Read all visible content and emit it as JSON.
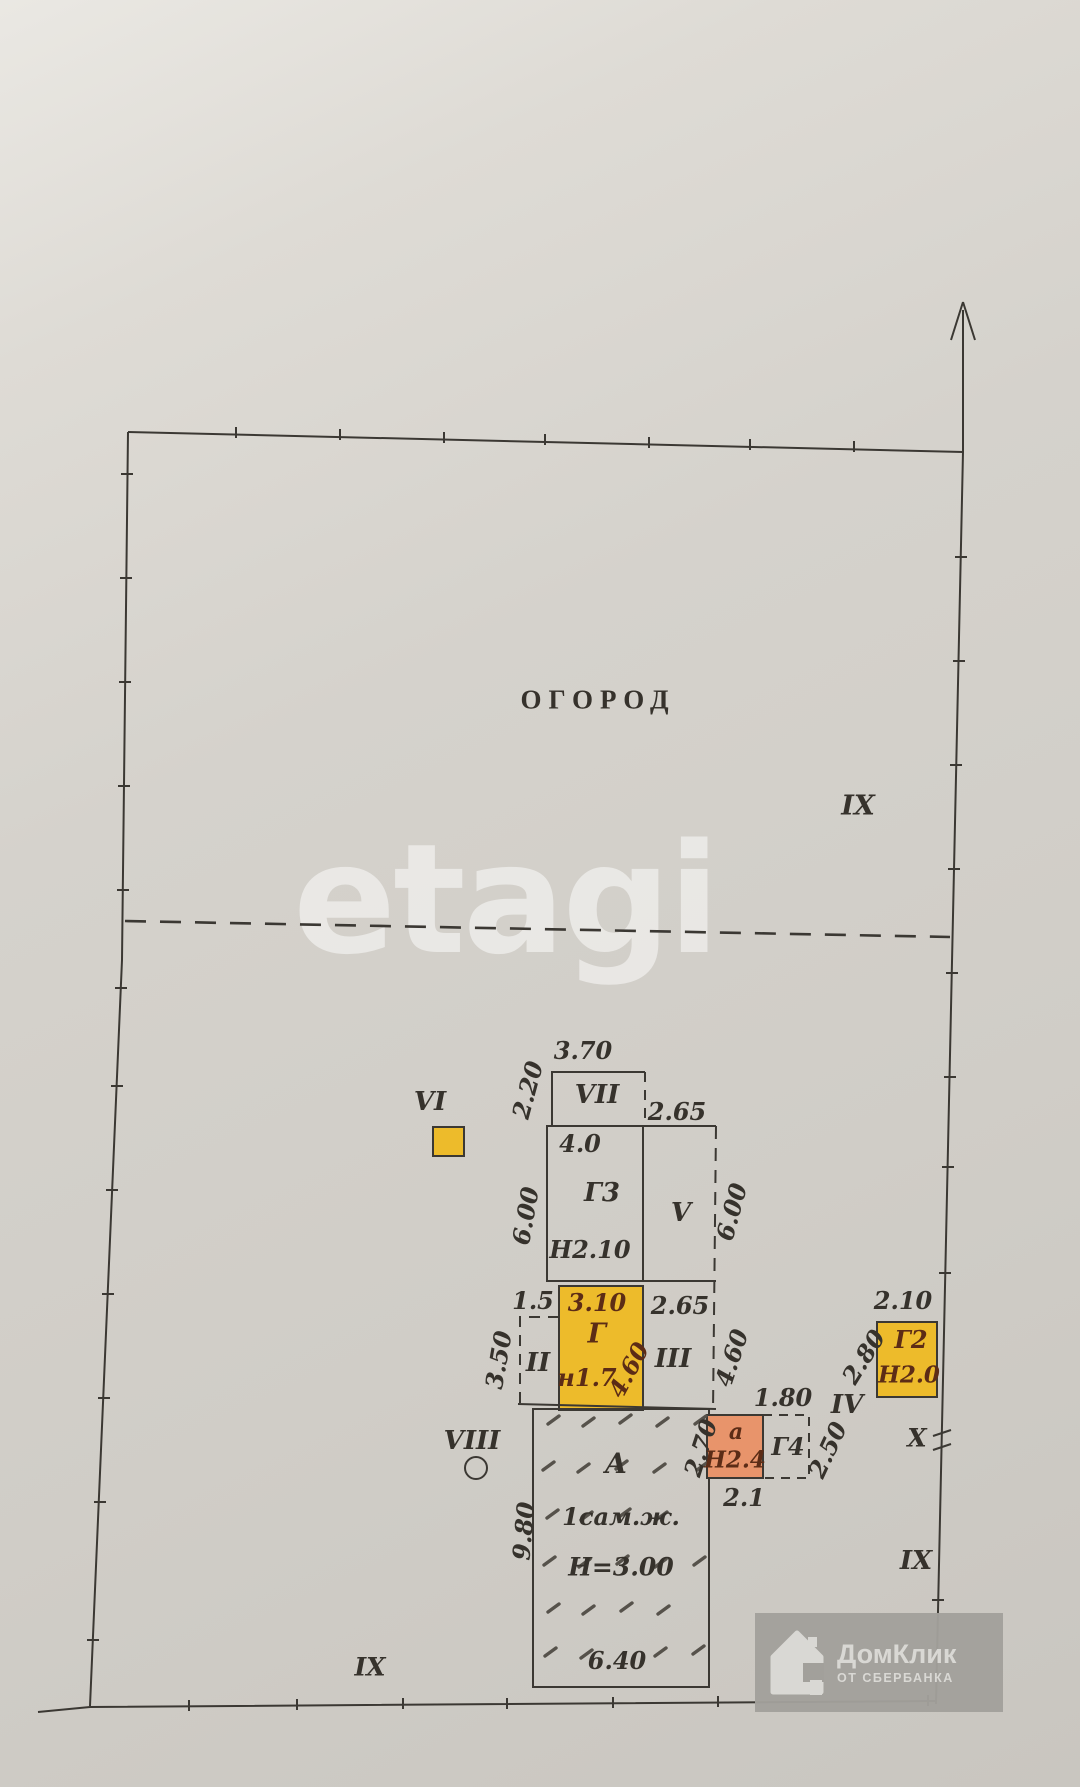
{
  "labels": {
    "garden": "ОГОРОД",
    "ix_upper": "IX",
    "ix_right": "IX",
    "ix_bottom": "IX",
    "vi": "VI",
    "vii": "VII",
    "v": "V",
    "ii": "II",
    "iii": "III",
    "iv": "IV",
    "viii": "VIII",
    "x": "Х"
  },
  "dimensions": {
    "vii_width": "3.70",
    "vii_height": "2.20",
    "v_top_width": "2.65",
    "v_height": "6.00",
    "g3_inner_width": "4.0",
    "g3_height": "6.00",
    "g_offset_left": "1.5",
    "g_width": "3.10",
    "g_diag_height": "4.60",
    "iii_top_width": "2.65",
    "iii_height": "4.60",
    "ii_height": "3.50",
    "a_height": "9.80",
    "a_width": "6.40",
    "a_ext_left_height": "2.70",
    "a_ext_bottom_width": "2.1",
    "g4_top_width": "1.80",
    "g4_right_height": "2.50",
    "iv_to_g2": "2.80",
    "g2_top_width": "2.10"
  },
  "buildings": {
    "g3": {
      "label": "Г3",
      "height_mark": "Н2.10"
    },
    "g": {
      "label": "Г",
      "height_mark": "н1.7"
    },
    "g2": {
      "label": "Г2",
      "height_mark": "Н2.0"
    },
    "g4": {
      "label": "Г4"
    },
    "a_ext": {
      "label": "а",
      "height_mark": "Н2.4"
    },
    "a": {
      "label": "А",
      "type_mark": "1сам.ж.",
      "height_mark": "Н=3.00"
    }
  },
  "watermarks": {
    "etagi_text": "etagi",
    "domclick_title": "ДомКлик",
    "domclick_subtitle": "ОТ СБЕРБАНКА"
  },
  "colors": {
    "paper": "#d5d2cc",
    "ink": "#3b3833",
    "building_yellow": "#edbb2b",
    "building_orange": "#e8946b",
    "annotation_red": "#5c2c16",
    "watermark_box_grey": "#a2a09b"
  }
}
